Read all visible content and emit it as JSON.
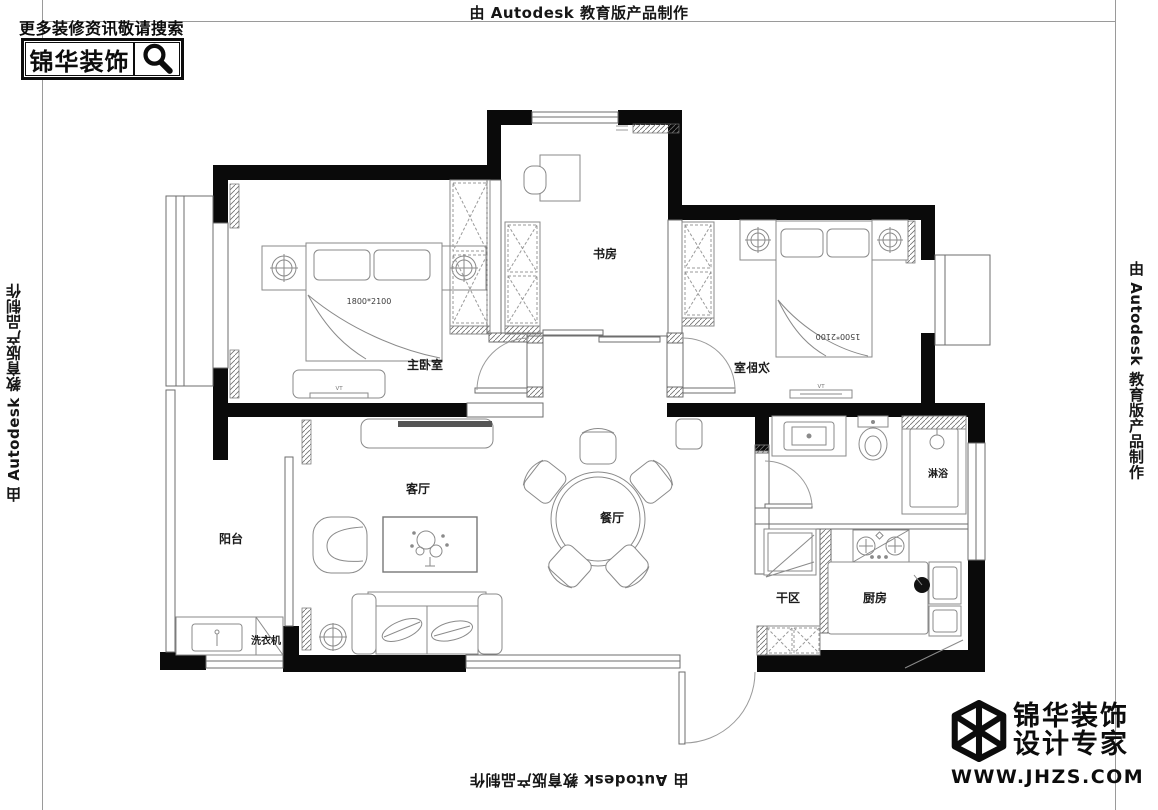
{
  "watermark": {
    "text": "由 Autodesk 教育版产品制作"
  },
  "search_banner": {
    "caption": "更多装修资讯敬请搜索",
    "brand": "锦华装饰",
    "icon": "magnifier-icon"
  },
  "brand_badge": {
    "name": "锦华装饰",
    "tagline": "设计专家",
    "website": "WWW.JHZS.COM",
    "icon": "cube-logo-icon"
  },
  "floor_plan": {
    "rooms": {
      "master_bedroom": "主卧室",
      "second_bedroom": "次卧室",
      "study": "书房",
      "living_room": "客厅",
      "dining_room": "餐厅",
      "balcony": "阳台",
      "kitchen": "厨房",
      "dry_area": "干区",
      "shower": "淋浴",
      "washing_machine": "洗衣机"
    },
    "dimensions": {
      "master_bed": "1800*2100",
      "second_bed": "1500*2100"
    },
    "furniture_labels": {
      "tv": "TV"
    },
    "colors": {
      "wall": "#0a0a0a",
      "line": "#8a8a8a"
    }
  }
}
